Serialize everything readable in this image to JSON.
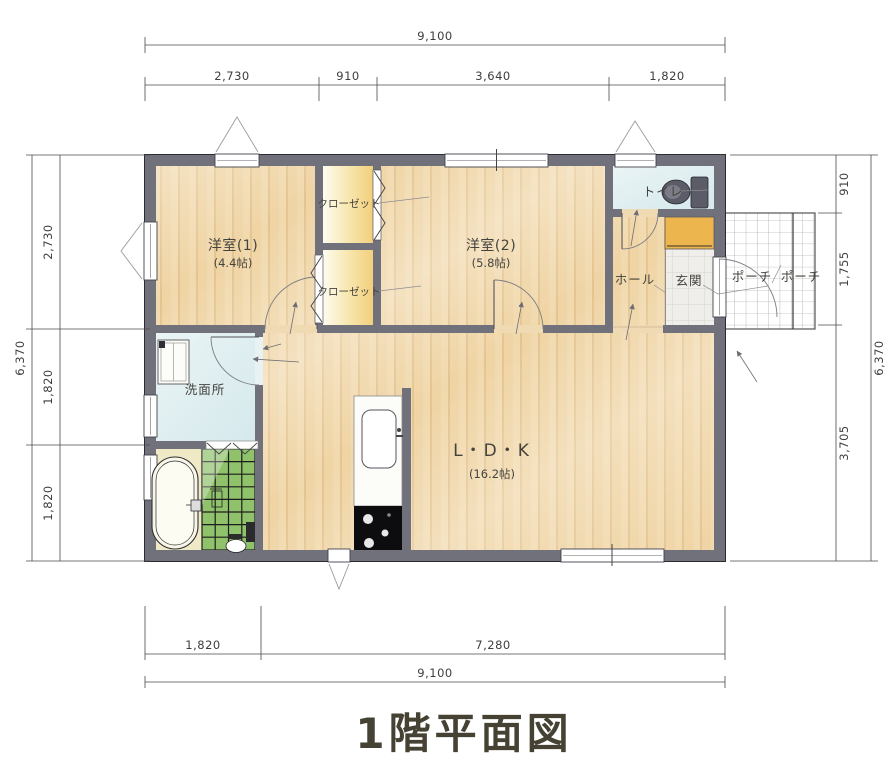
{
  "title": "1階平面図",
  "rooms": {
    "bedroom1": {
      "name": "洋室(1)",
      "size": "(4.4帖)"
    },
    "bedroom2": {
      "name": "洋室(2)",
      "size": "(5.8帖)"
    },
    "ldk": {
      "name": "L・D・K",
      "size": "(16.2帖)"
    },
    "closet_upper": {
      "name": "クローゼット"
    },
    "closet_lower": {
      "name": "クローゼット"
    },
    "toilet": {
      "name": "トイレ"
    },
    "hall": {
      "name": "ホール"
    },
    "entrance": {
      "name": "玄関"
    },
    "porch_inner": {
      "name": "ポーチ"
    },
    "porch_outer": {
      "name": "ポーチ"
    },
    "washroom": {
      "name": "洗面所"
    }
  },
  "dimensions": {
    "top": {
      "total": "9,100",
      "segments": [
        "2,730",
        "910",
        "3,640",
        "1,820"
      ]
    },
    "bottom": {
      "total": "9,100",
      "segments": [
        "1,820",
        "7,280"
      ]
    },
    "left": {
      "total": "6,370",
      "segments": [
        "2,730",
        "1,820",
        "1,820"
      ]
    },
    "right": {
      "total": "6,370",
      "segments": [
        "910",
        "1,755",
        "3,705"
      ]
    }
  },
  "colors": {
    "wall": "#71717b",
    "wood_floor": "#f1d9ad",
    "closet_floor": "#f8e7b0",
    "wet_room_floor": "#e3f0f2",
    "bath_tile_green": "#8fc26a",
    "shoe_cabinet": "#ecb54d",
    "title": "#454233"
  }
}
